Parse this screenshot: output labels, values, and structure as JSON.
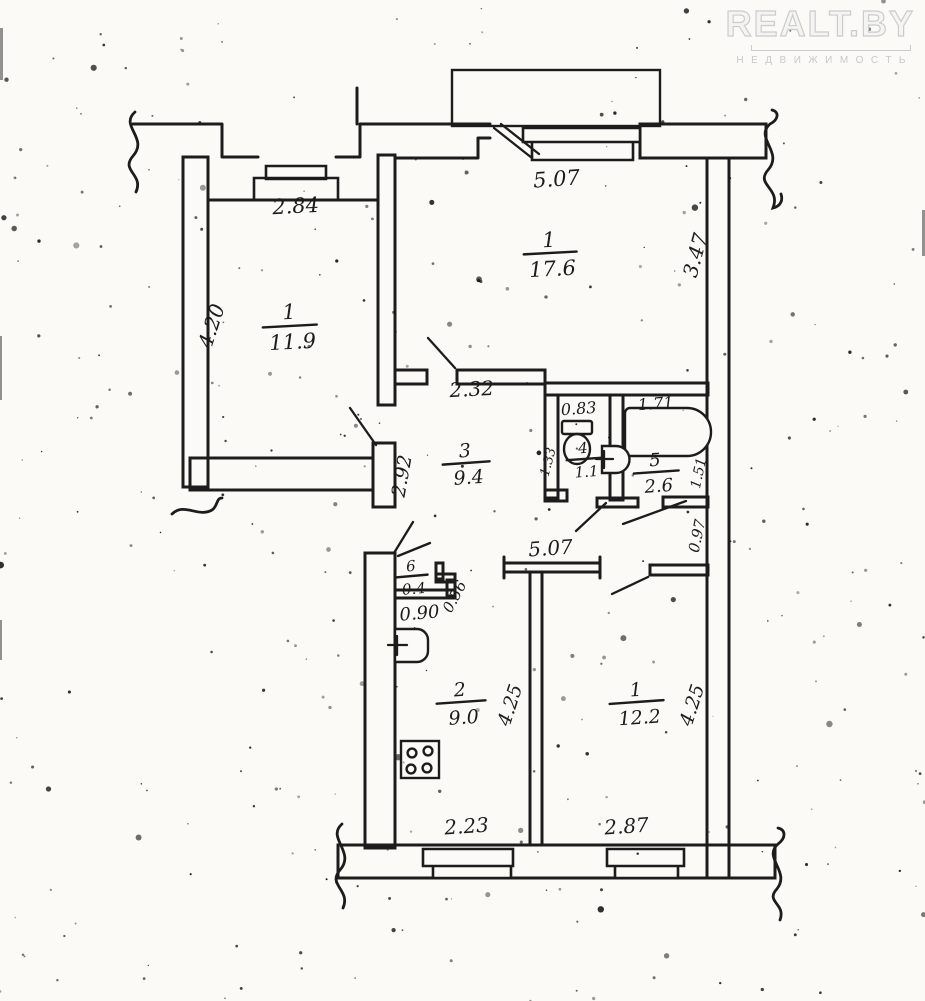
{
  "watermark": {
    "brand": "REALT.BY",
    "subtitle": "НЕДВИЖИМОСТЬ"
  },
  "plan": {
    "ink": "#1c1c1c",
    "paper": "#fbfaf7",
    "watermark_color": "#cccccc",
    "rooms": {
      "living_top": {
        "number": "1",
        "area": "17.6"
      },
      "bedroom_left": {
        "number": "1",
        "area": "11.9"
      },
      "hall": {
        "number": "3",
        "area": "9.4"
      },
      "wc": {
        "number": "4",
        "area": "1.1"
      },
      "bath": {
        "number": "5",
        "area": "2.6"
      },
      "closet": {
        "number": "6",
        "area": "0.4"
      },
      "kitchen": {
        "number": "2",
        "area": "9.0"
      },
      "room_bottom": {
        "number": "1",
        "area": "12.2"
      }
    },
    "dims": {
      "top_width": "5.07",
      "top_depth": "3.47",
      "left_width": "2.84",
      "left_depth": "4.20",
      "hall_width": "2.32",
      "hall_depth": "2.92",
      "wc_width": "0.83",
      "wc_depth": "1.33",
      "bath_width": "1.71",
      "bath_depth": "1.51",
      "pier": "0.97",
      "lower_width": "5.07",
      "closet_side": "0.56",
      "closet_front": "0.90",
      "kitchen_depth": "4.25",
      "kitchen_width": "2.23",
      "bottom_room_depth": "4.25",
      "bottom_room_width": "2.87"
    }
  }
}
